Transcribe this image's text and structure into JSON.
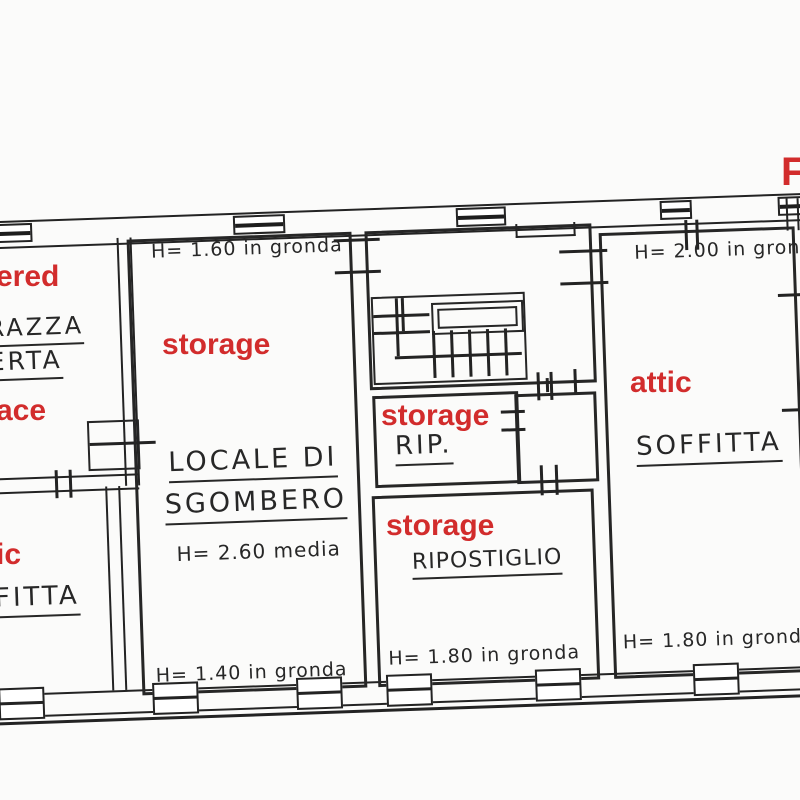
{
  "colors": {
    "annotation_red": "#d22c2c",
    "ink": "#262626",
    "paper": "#fbfbfa"
  },
  "corner_fragment": "F",
  "rooms": {
    "terrace": {
      "en_fragment_top": "ered",
      "en_fragment_bottom": "ace",
      "it_line1": "RAZZA",
      "it_line2": "ERTA"
    },
    "storage_main": {
      "en": "storage",
      "it_line1": "LOCALE DI",
      "it_line2": "SGOMBERO",
      "height_top": "H= 1.60 in gronda",
      "height_mid": "H= 2.60 media",
      "height_bottom": "H= 1.40 in gronda"
    },
    "rip": {
      "en": "storage",
      "it": "RIP."
    },
    "ripostiglio": {
      "en": "storage",
      "it": "RIPOSTIGLIO",
      "height_bottom": "H= 1.80 in gronda"
    },
    "attic_right": {
      "en": "attic",
      "it": "SOFFITTA",
      "height_top": "H= 2.00 in gronda",
      "height_bottom": "H= 1.80 in gronda"
    },
    "attic_left": {
      "en_fragment": "ic",
      "it_fragment": "FITTA"
    }
  }
}
